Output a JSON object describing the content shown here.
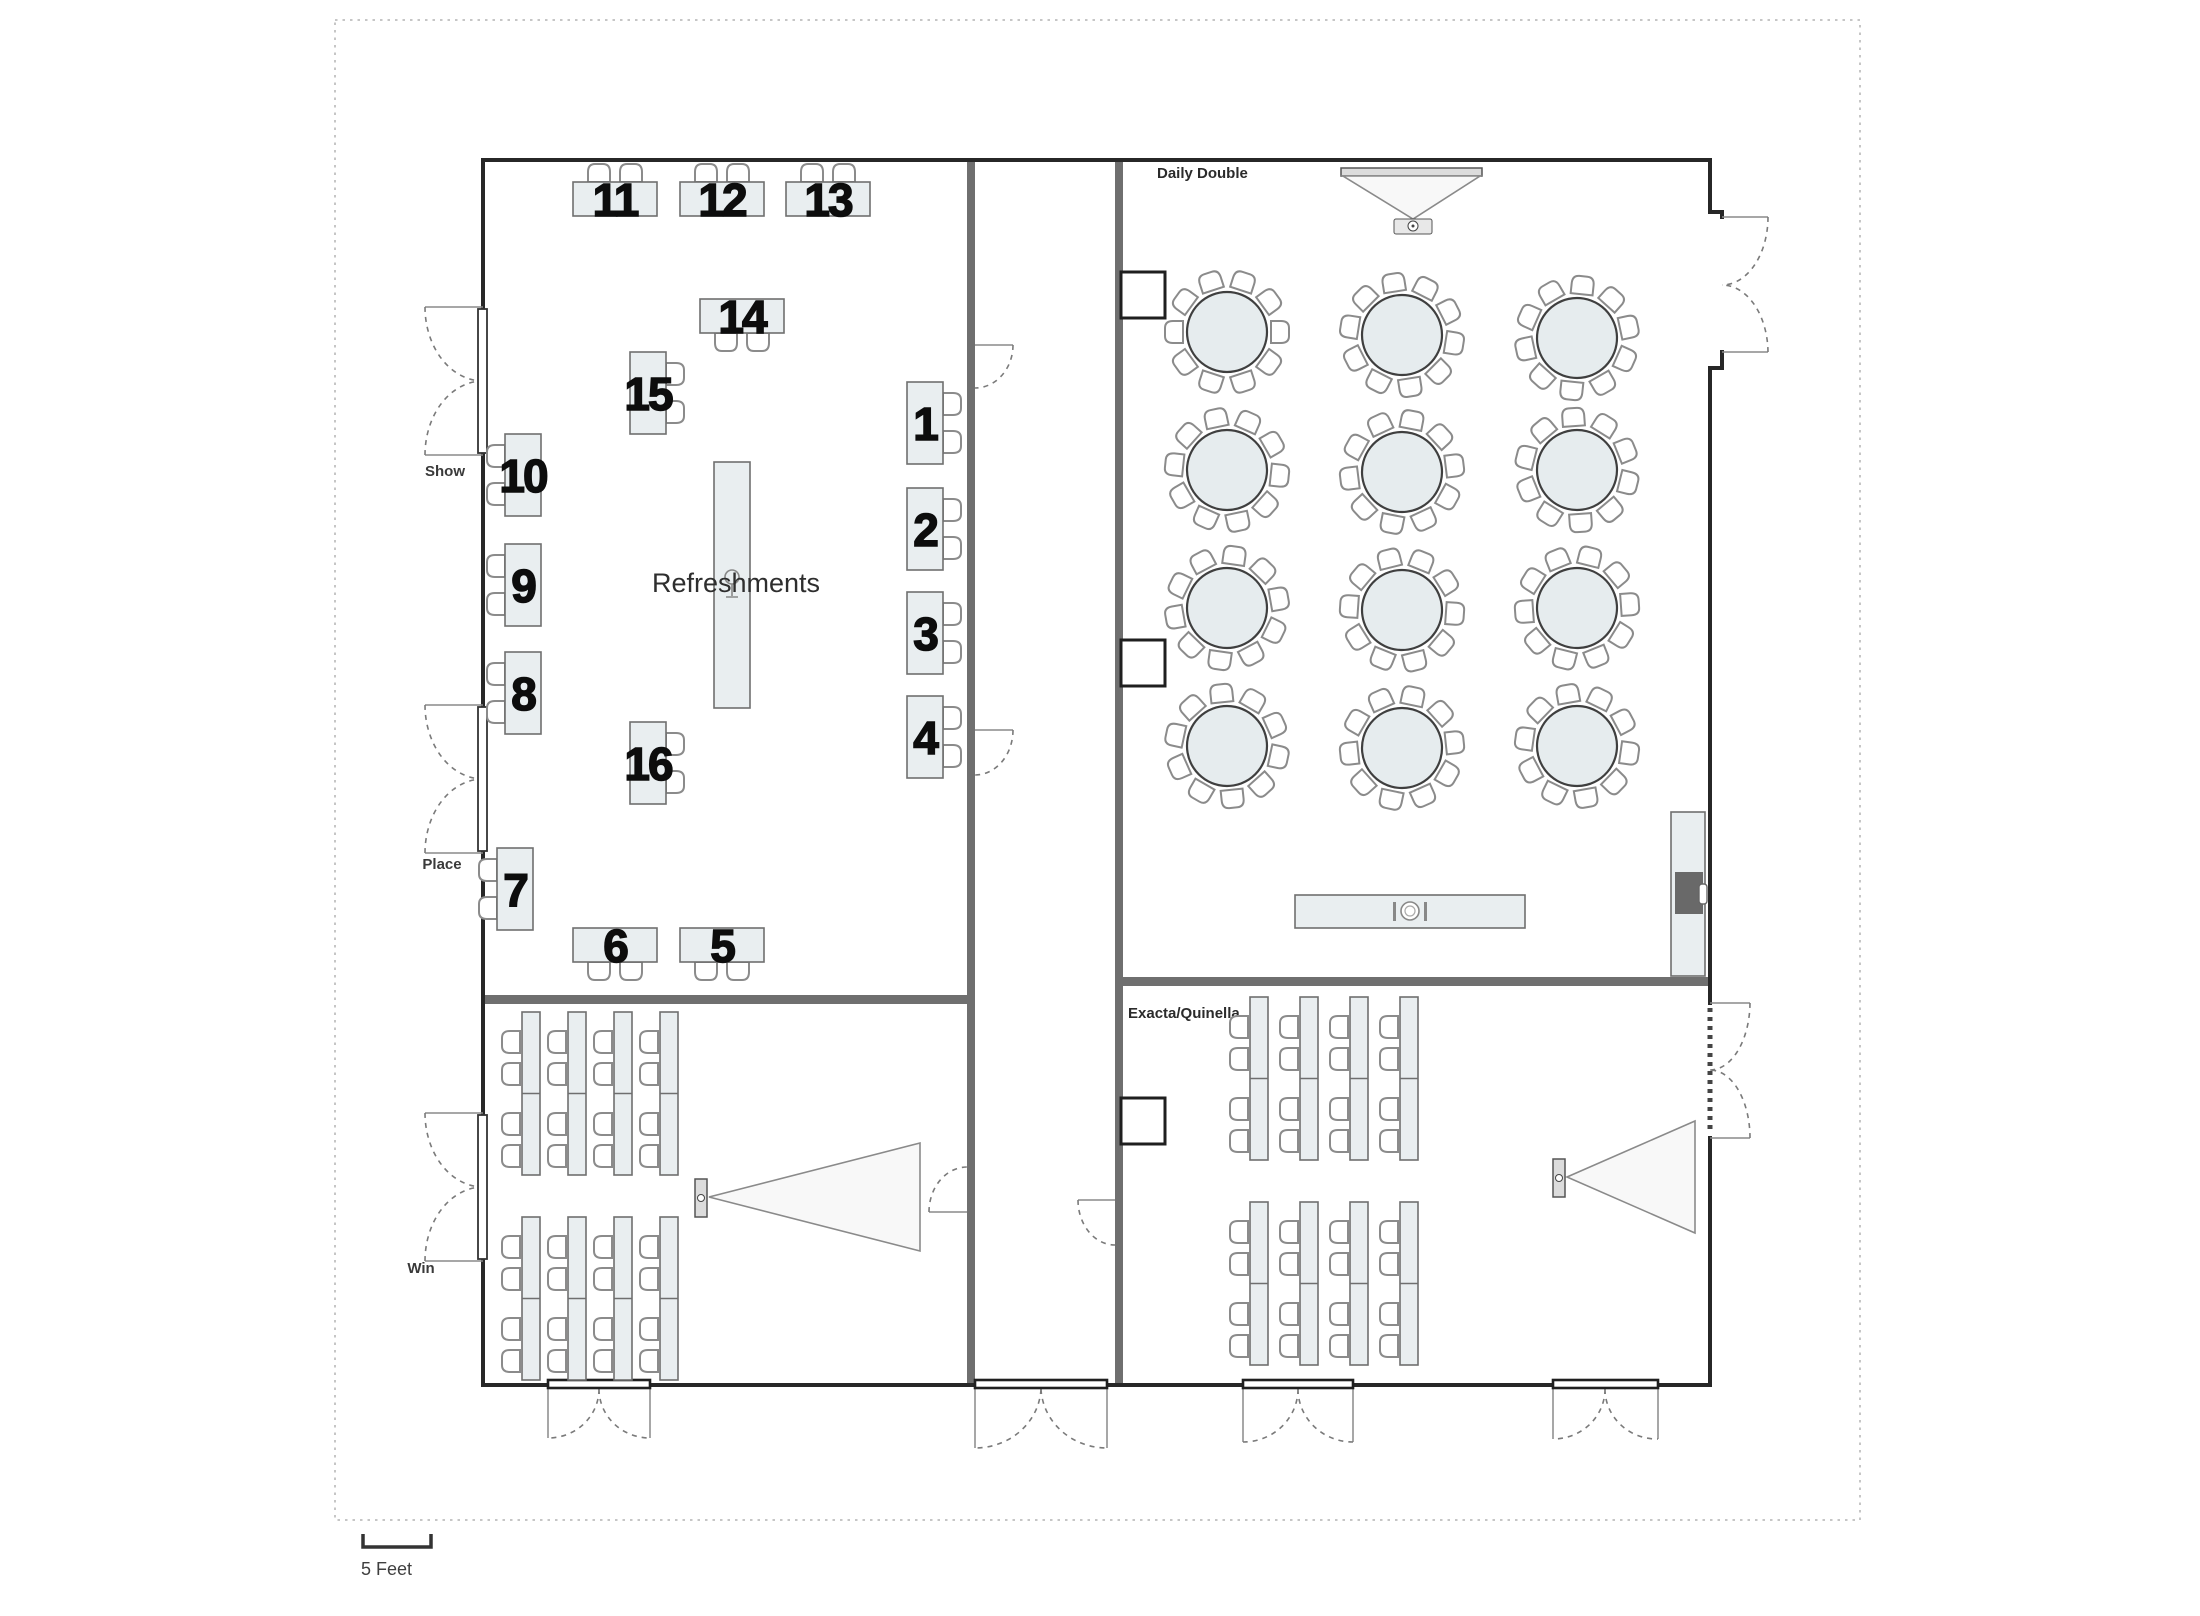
{
  "diagram": {
    "type": "banquet and classroom venue floor plan",
    "scale_label": "5 Feet"
  },
  "rooms": {
    "daily_double": {
      "label": "Daily Double",
      "round_tables": 12,
      "chairs_per_round_table": 10,
      "buffet_icon": "place-setting-icon",
      "equipment": [
        "projection-screen",
        "projector",
        "av-table"
      ]
    },
    "exacta_quinella": {
      "label": "Exacta/Quinella",
      "table_columns": 4,
      "column_groups": 2,
      "chairs_per_column": 4,
      "equipment": [
        "projection-screen",
        "projector"
      ]
    },
    "win_room": {
      "table_columns": 4,
      "column_groups": 2,
      "chairs_per_column": 4,
      "equipment": [
        "projection-screen",
        "projector"
      ]
    },
    "refreshments_room": {
      "label": "Refreshments",
      "numbered_tables": 16
    }
  },
  "door_labels": {
    "show": "Show",
    "place": "Place",
    "win": "Win"
  },
  "tables": {
    "t1": "1",
    "t2": "2",
    "t3": "3",
    "t4": "4",
    "t5": "5",
    "t6": "6",
    "t7": "7",
    "t8": "8",
    "t9": "9",
    "t10": "10",
    "t11": "11",
    "t12": "12",
    "t13": "13",
    "t14": "14",
    "t15": "15",
    "t16": "16"
  },
  "icons": {
    "place_setting": "place-setting-icon",
    "wine_glass": "wine-glass-icon",
    "projector": "projector-icon",
    "screen": "projection-screen-icon",
    "chair": "chair-icon",
    "door_swing": "door-swing-icon"
  },
  "colors": {
    "wall": "#272727",
    "partition": "#6f6f6f",
    "table_fill": "#e9eef0",
    "table_border": "#6f6f6f",
    "screen_fill": "#f8f8f8",
    "text": "#2e2e2e",
    "background": "#ffffff"
  }
}
